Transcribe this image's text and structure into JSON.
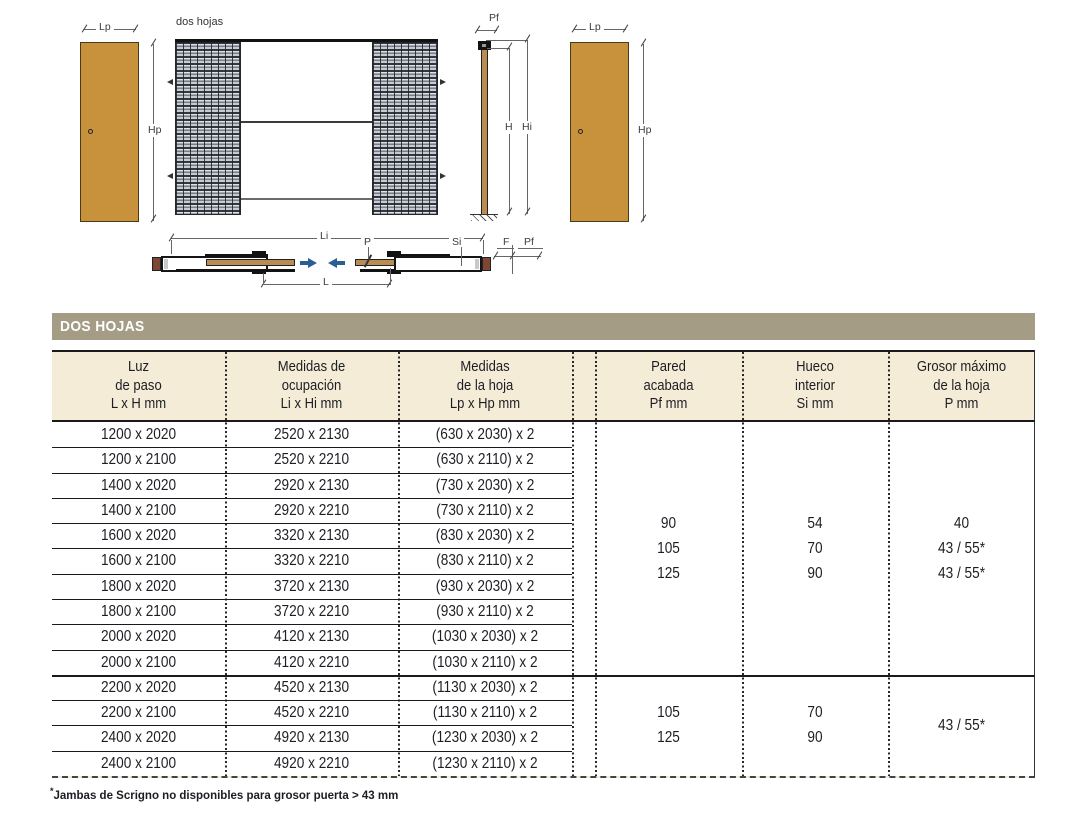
{
  "colors": {
    "door": "#c8913c",
    "leaf-plan": "#b98c52",
    "jamb": "#7d4733",
    "title-bar": "#a49c84",
    "header-bg": "#f4ecd7",
    "arrow-blue": "#2a5f94"
  },
  "diagram": {
    "caption": "dos hojas",
    "dims": {
      "lp": "Lp",
      "hp": "Hp",
      "pf": "Pf",
      "h": "H",
      "hi": "Hi",
      "li": "Li",
      "l": "L",
      "p": "P",
      "si": "Si",
      "f": "F"
    }
  },
  "table": {
    "title": "DOS HOJAS",
    "headers": [
      {
        "l1": "Luz",
        "l2": "de paso",
        "l3": "L x H mm"
      },
      {
        "l1": "Medidas de",
        "l2": "ocupación",
        "l3": "Li x Hi mm"
      },
      {
        "l1": "Medidas",
        "l2": "de la hoja",
        "l3": "Lp x Hp mm"
      },
      {
        "l1": "Pared",
        "l2": "acabada",
        "l3": "Pf mm"
      },
      {
        "l1": "Hueco",
        "l2": "interior",
        "l3": "Si mm"
      },
      {
        "l1": "Grosor máximo",
        "l2": "de la hoja",
        "l3": "P mm"
      }
    ],
    "rows": [
      {
        "luz": "1200 x 2020",
        "ocupacion": "2520 x 2130",
        "hoja": "(630 x 2030) x 2"
      },
      {
        "luz": "1200 x 2100",
        "ocupacion": "2520 x 2210",
        "hoja": "(630 x 2110) x 2"
      },
      {
        "luz": "1400 x 2020",
        "ocupacion": "2920 x 2130",
        "hoja": "(730 x 2030) x 2"
      },
      {
        "luz": "1400 x 2100",
        "ocupacion": "2920 x 2210",
        "hoja": "(730 x 2110) x 2"
      },
      {
        "luz": "1600 x 2020",
        "ocupacion": "3320 x 2130",
        "hoja": "(830 x 2030) x 2"
      },
      {
        "luz": "1600 x 2100",
        "ocupacion": "3320 x 2210",
        "hoja": "(830 x 2110) x 2"
      },
      {
        "luz": "1800 x 2020",
        "ocupacion": "3720 x 2130",
        "hoja": "(930 x 2030) x 2"
      },
      {
        "luz": "1800 x 2100",
        "ocupacion": "3720 x 2210",
        "hoja": "(930 x 2110) x 2"
      },
      {
        "luz": "2000 x 2020",
        "ocupacion": "4120 x 2130",
        "hoja": "(1030 x 2030) x 2"
      },
      {
        "luz": "2000 x 2100",
        "ocupacion": "4120 x 2210",
        "hoja": "(1030 x 2110) x 2"
      },
      {
        "luz": "2200 x 2020",
        "ocupacion": "4520 x 2130",
        "hoja": "(1130 x 2030) x 2"
      },
      {
        "luz": "2200 x 2100",
        "ocupacion": "4520 x 2210",
        "hoja": "(1130 x 2110) x 2"
      },
      {
        "luz": "2400 x 2020",
        "ocupacion": "4920 x 2130",
        "hoja": "(1230 x 2030) x 2"
      },
      {
        "luz": "2400 x 2100",
        "ocupacion": "4920 x 2210",
        "hoja": "(1230 x 2110) x 2"
      }
    ],
    "groups": [
      {
        "pared": [
          "90",
          "105",
          "125"
        ],
        "hueco": [
          "54",
          "70",
          "90"
        ],
        "grosor": [
          "40",
          "43 / 55*",
          "43 / 55*"
        ]
      },
      {
        "pared": [
          "105",
          "125"
        ],
        "hueco": [
          "70",
          "90"
        ],
        "grosor": [
          "43 / 55*"
        ]
      }
    ]
  },
  "footnote": {
    "marker": "*",
    "text": "Jambas de Scrigno no disponibles para grosor puerta > 43 mm"
  }
}
